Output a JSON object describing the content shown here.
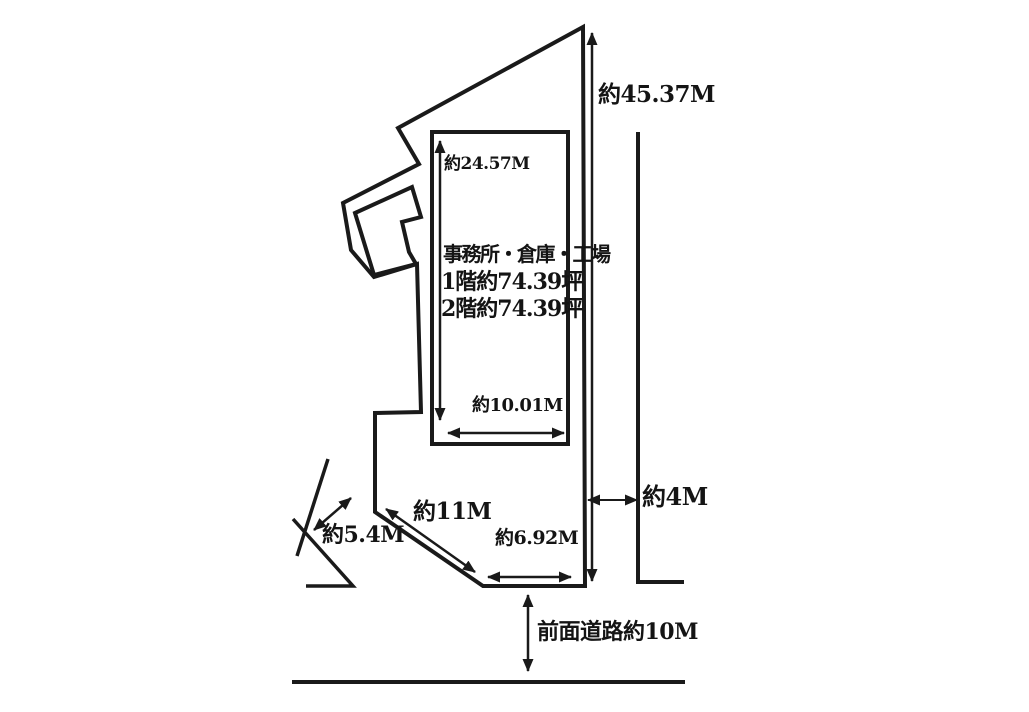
{
  "meta": {
    "background_color": "#ffffff",
    "line_color": "#1a1a1a"
  },
  "diagram": {
    "type": "property-site-plan",
    "building": {
      "name": "事務所・倉庫・工場",
      "floor1": "1階約74.39坪",
      "floor2": "2階約74.39坪"
    },
    "dimensions": {
      "right_side": "約45.37M",
      "building_depth": "約24.57M",
      "building_width": "約10.01M",
      "slant_edge": "約11M",
      "side_road_width": "約5.4M",
      "frontage": "約6.92M",
      "setback": "約4M",
      "front_road": "前面道路約10M"
    }
  }
}
